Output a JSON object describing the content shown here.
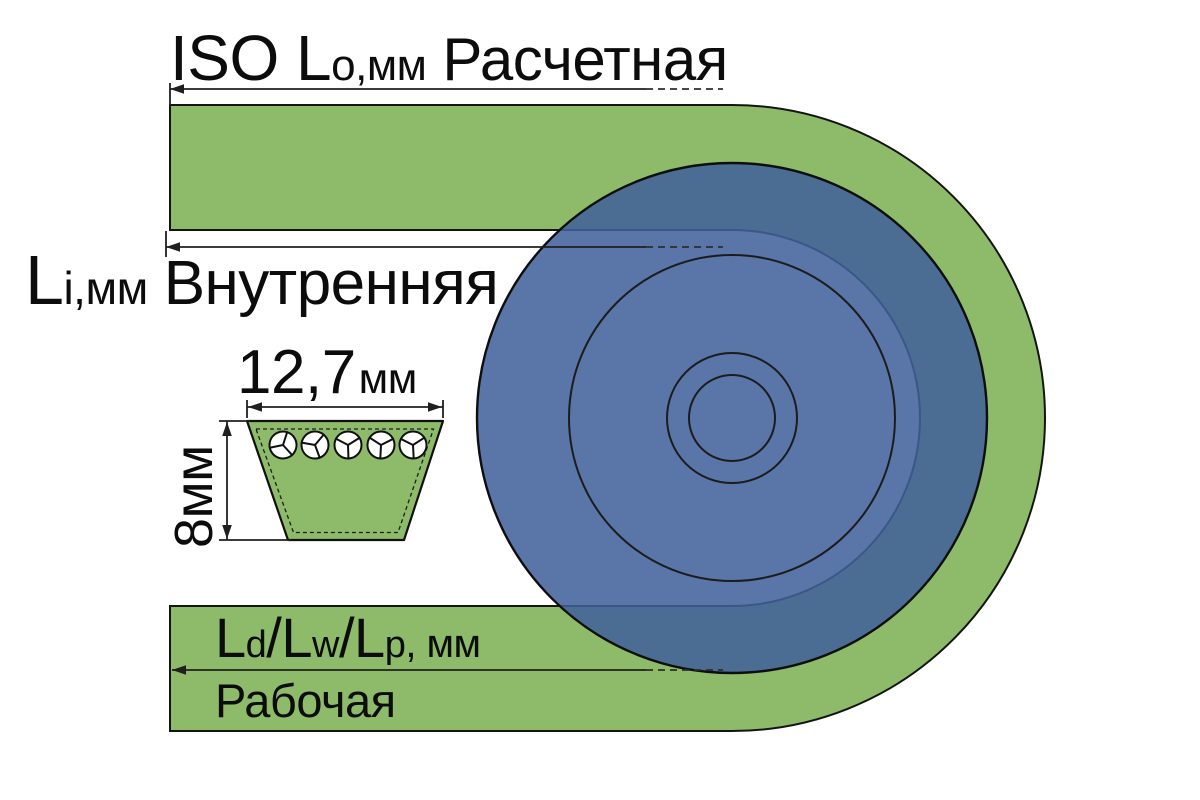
{
  "diagram": {
    "title": "V-belt length designation diagram",
    "colors": {
      "belt_green": "#8EBB69",
      "pulley_blue": "#42609A",
      "outline": "#141414"
    },
    "outer_length": {
      "main": "ISO L",
      "sub": "o",
      "unit": ",мм",
      "title": "Расчетная"
    },
    "inner_length": {
      "main": "L",
      "sub": "i",
      "unit": ",мм",
      "title": "Внутренняя"
    },
    "working_length": {
      "m1": "L",
      "s1": "d",
      "sl1": "/",
      "m2": "L",
      "s2": "w",
      "sl2": "/",
      "m3": "L",
      "s3": "p",
      "unit": ", мм",
      "title": "Рабочая"
    },
    "cross_section": {
      "width_value": "12,7",
      "width_unit": "мм",
      "height_value": "8мм"
    }
  }
}
